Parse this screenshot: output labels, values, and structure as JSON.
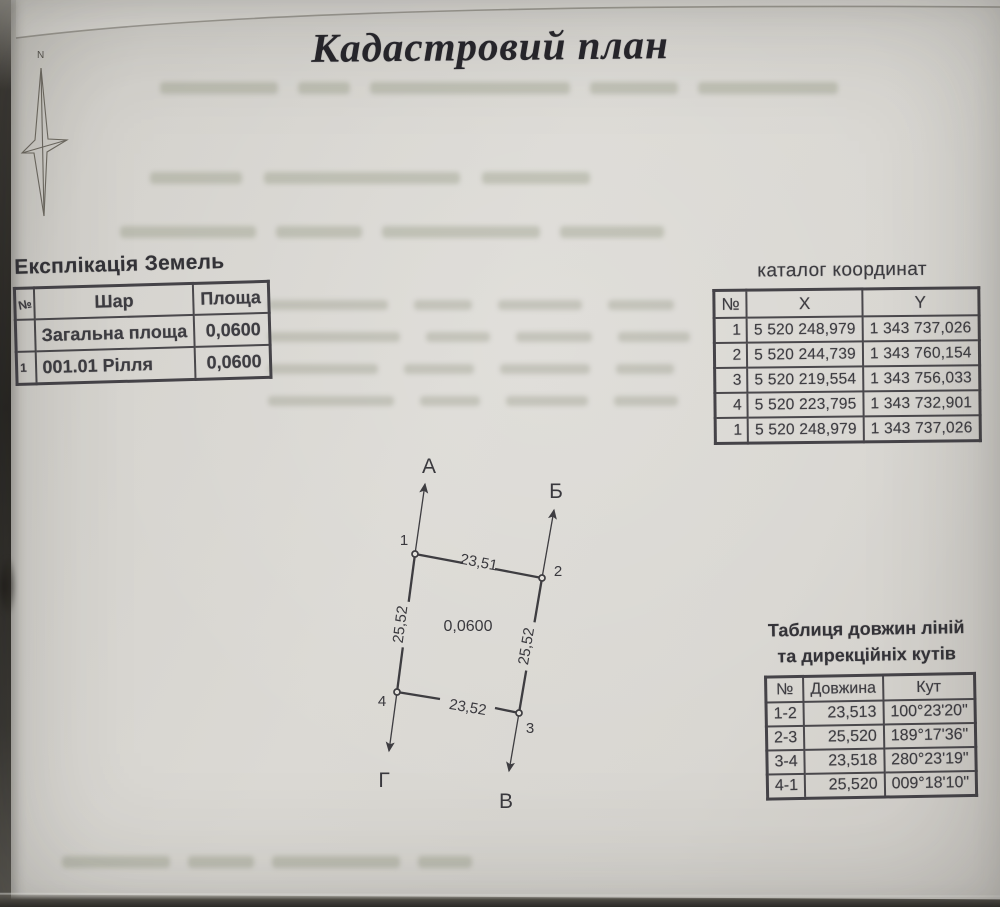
{
  "page": {
    "title": "Кадастровий план"
  },
  "north": {
    "label": "N"
  },
  "explication": {
    "heading": "Експлікація Земель",
    "columns": {
      "num": "№",
      "layer": "Шар",
      "area": "Площа"
    },
    "rows": [
      {
        "num": "",
        "layer": "Загальна площа",
        "area": "0,0600"
      },
      {
        "num": "1",
        "layer": "001.01 Рілля",
        "area": "0,0600"
      }
    ]
  },
  "coordinates": {
    "title": "каталог координат",
    "columns": {
      "num": "№",
      "x": "X",
      "y": "Y"
    },
    "rows": [
      {
        "num": "1",
        "x": "5 520 248,979",
        "y": "1 343 737,026"
      },
      {
        "num": "2",
        "x": "5 520 244,739",
        "y": "1 343 760,154"
      },
      {
        "num": "3",
        "x": "5 520 219,554",
        "y": "1 343 756,033"
      },
      {
        "num": "4",
        "x": "5 520 223,795",
        "y": "1 343 732,901"
      },
      {
        "num": "1",
        "x": "5 520 248,979",
        "y": "1 343 737,026"
      }
    ]
  },
  "lines_table": {
    "title_line1": "Таблиця довжин ліній",
    "title_line2": "та дирекційніх кутів",
    "columns": {
      "num": "№",
      "length": "Довжина",
      "angle": "Кут"
    },
    "rows": [
      {
        "num": "1-2",
        "length": "23,513",
        "angle": "100°23'20\""
      },
      {
        "num": "2-3",
        "length": "25,520",
        "angle": "189°17'36\""
      },
      {
        "num": "3-4",
        "length": "23,518",
        "angle": "280°23'19\""
      },
      {
        "num": "4-1",
        "length": "25,520",
        "angle": "009°18'10\""
      }
    ]
  },
  "plot": {
    "area_label": "0,0600",
    "vertex_labels": {
      "p1": "1",
      "p2": "2",
      "p3": "3",
      "p4": "4"
    },
    "direction_labels": {
      "a": "А",
      "b": "Б",
      "v": "В",
      "g": "Г"
    },
    "side_labels": {
      "top": "23,51",
      "right": "25,52",
      "bottom": "23,52",
      "left": "25,52"
    }
  }
}
